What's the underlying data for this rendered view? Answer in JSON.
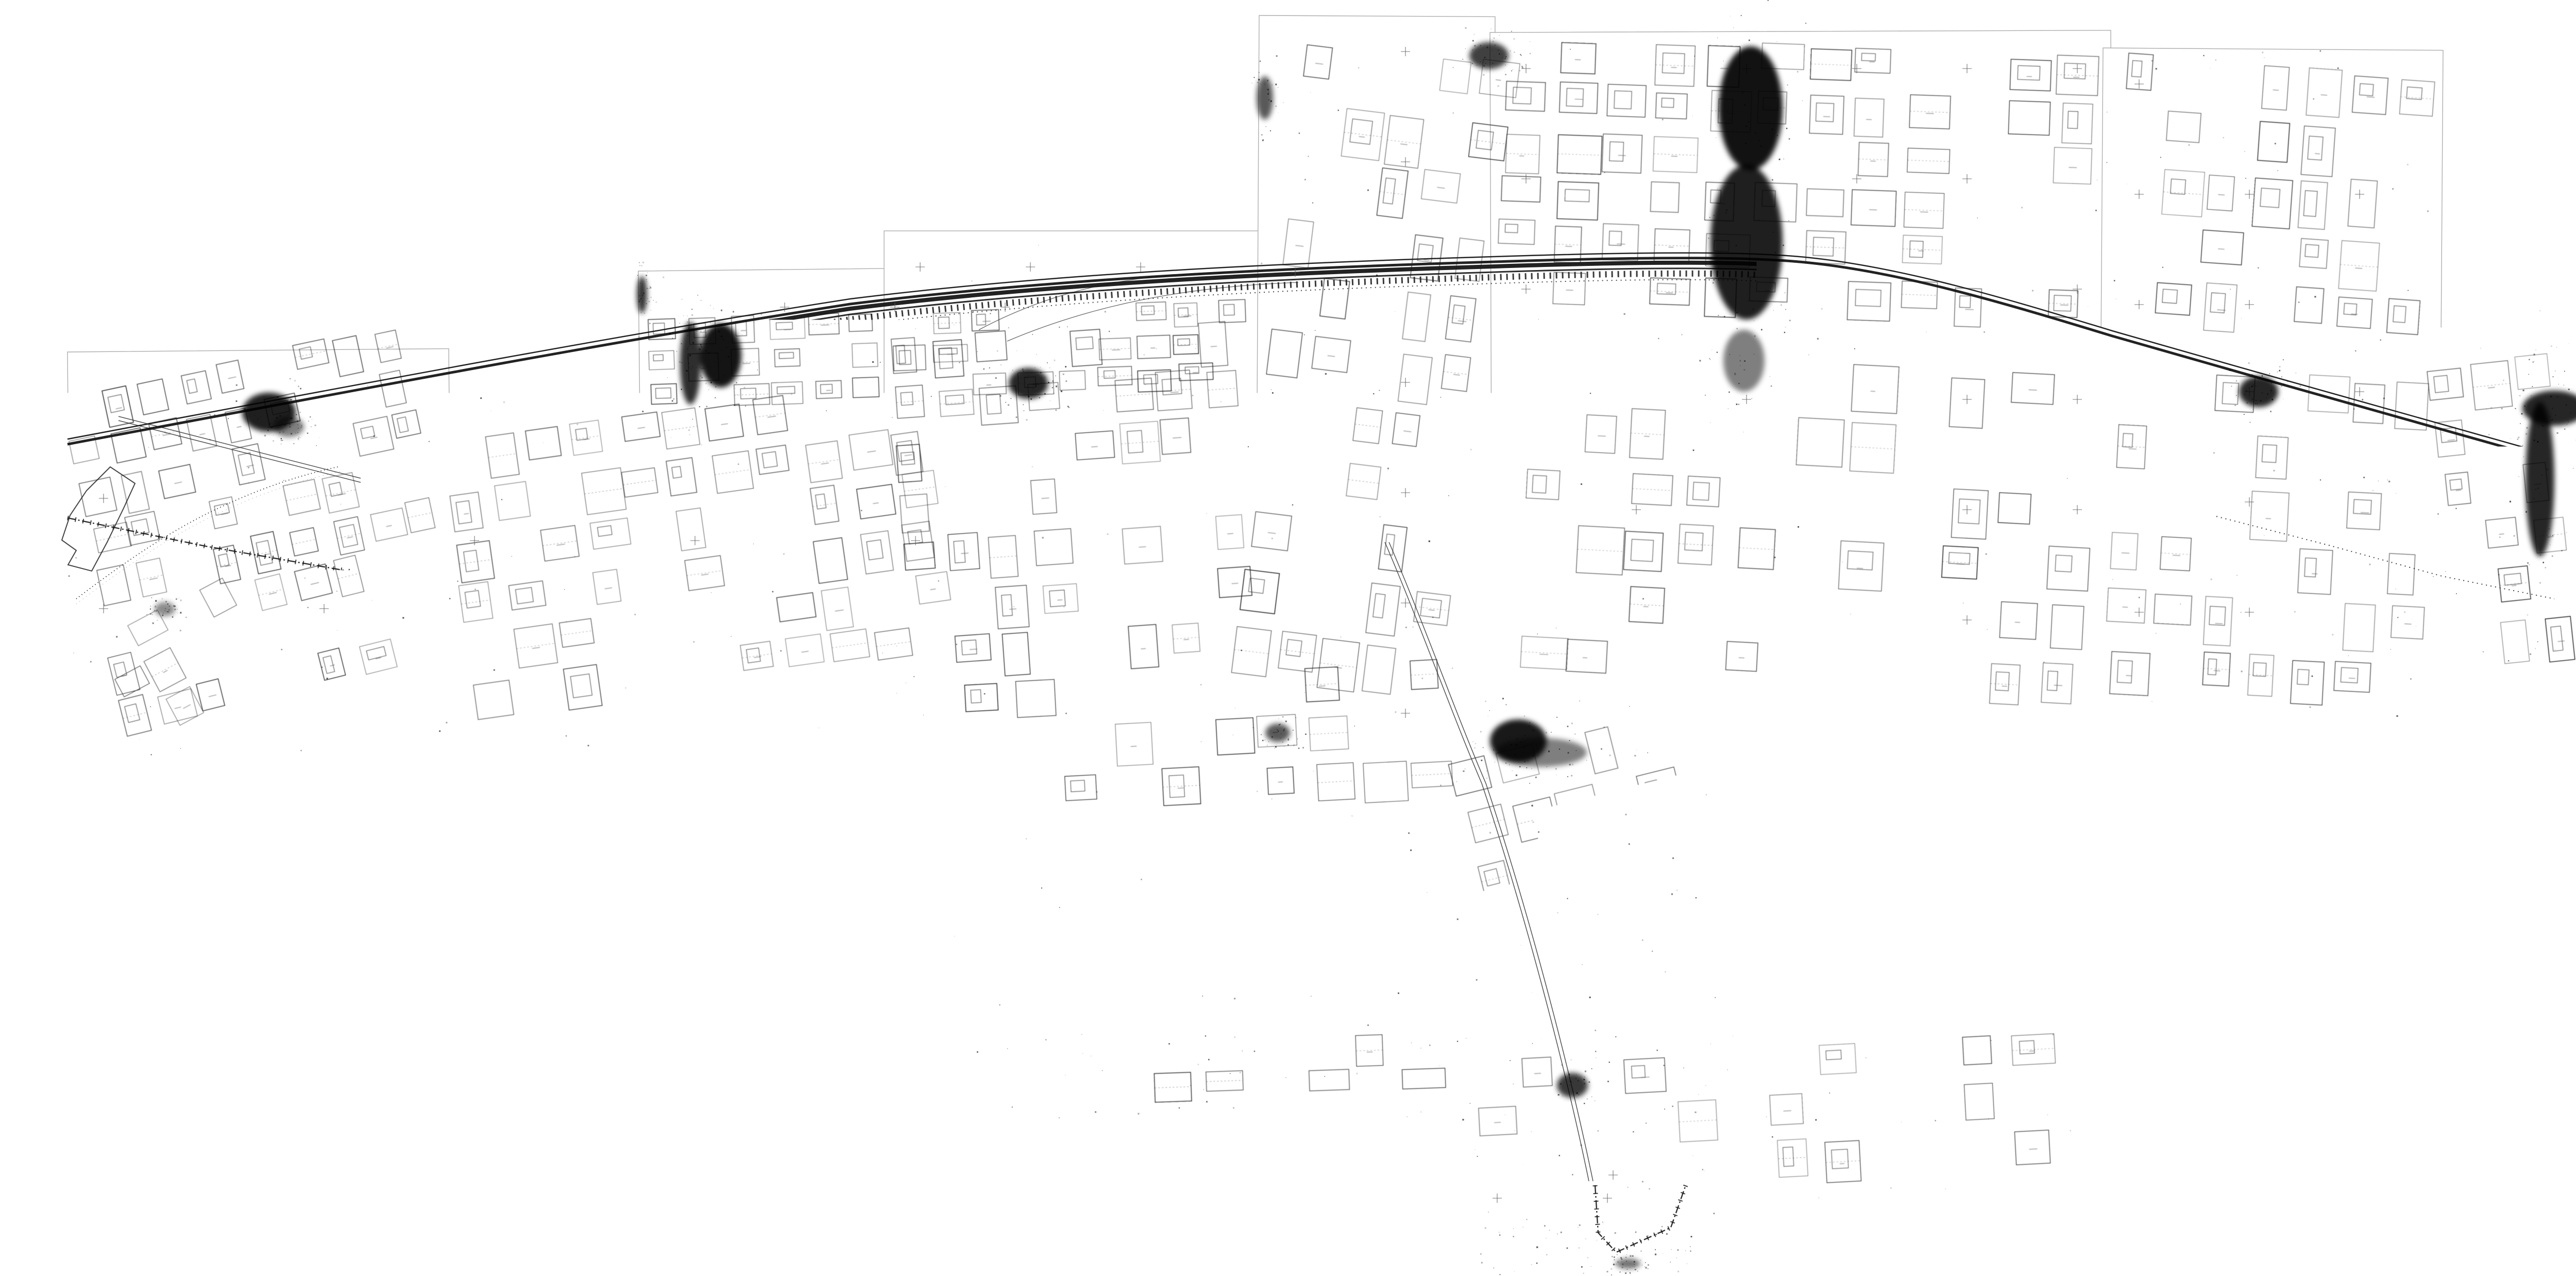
{
  "scale_label": "ΚΛΙΜΑΚΑ 1:500",
  "stamp": {
    "ministry_line1": "ΥΠΟΥΡΓΕΙΟ",
    "ministry_line2": "ΠΕΡΙΒΑΛΛΟΝΤΟΣ ΧΩΡΟΤΑΞΙΑΣ & ΔΗΜ. ΕΡΓΩΝ",
    "ref_no": "Γ.Β.8602/95",
    "date": "15 Μαΐου 1995",
    "signer_title": "Ο Διευθυντής",
    "office": "Γρ. Αποτυπώσεων"
  },
  "notes": {
    "file_no": "Αρ.Φ.Δ. 130/95",
    "sheet_no": "Αρ.Σχ. 27"
  },
  "colors": {
    "ink": "#161616",
    "faint": "#555555",
    "sheet_border": "#ADADAD",
    "paper": "#FFFFFF"
  },
  "map": {
    "sheets": [
      [
        1239,
        526,
        1230,
        272,
        -0.6
      ],
      [
        1716,
        448,
        738,
        1018,
        0
      ],
      [
        2444,
        30,
        458,
        1425,
        0.3
      ],
      [
        2892,
        63,
        1205,
        1350,
        -0.2
      ],
      [
        4082,
        93,
        660,
        610,
        0.4
      ],
      [
        4082,
        690,
        668,
        722,
        0
      ],
      [
        131,
        683,
        740,
        785,
        -0.5
      ],
      [
        851,
        765,
        1005,
        700,
        0.2
      ],
      [
        1847,
        1287,
        1002,
        816,
        0
      ],
      [
        2836,
        1399,
        546,
        1049,
        0
      ],
      [
        4731,
        664,
        516,
        650,
        -0.3
      ],
      [
        5238,
        1392,
        478,
        710,
        0.5
      ],
      [
        2847,
        1996,
        1183,
        373,
        0
      ],
      [
        1933,
        2000,
        920,
        170,
        0
      ],
      [
        2873,
        2369,
        429,
        105,
        0
      ]
    ],
    "paths": {
      "rail_main": "M131,862 C700,755 1200,660 1650,590 C2050,540 2500,520 2900,508 C3150,500 3330,498 3450,505 C3650,515 3880,585 4100,652 C4420,745 4800,848 5030,915 C5140,948 5210,965 5247,975",
      "rail_s12": "M5542,1398 C5585,1560 5640,1760 5672,1880 C5692,1958 5702,2010 5706,2060",
      "bndA": "M131,1005 L400,1060 L870,1142 L1180,1260 L1430,1322 L1854,1305 L2200,1345 L2560,1380 L2836,1402 L2912,1505 L2945,1710 L2908,1985 L2884,2290 L3095,2298 L3228,2278 L3425,2182 L3705,2256 L3992,2142 L4028,2098",
      "bndTail": "M3096,2300 L3102,2392 L3137,2430 L3243,2382 L3272,2300",
      "bndS12": "M5366,1560 L5420,1752 L5482,1952 L5520,2088",
      "coast": "M148,1162 C240,1092 330,1030 420,988 C520,940 600,918 660,905",
      "coast2": "M1854,1420 C2100,1520 2300,1640 2450,1760 C2560,1850 2650,1960 2700,2060",
      "pier": "M214,906 L168,952 L136,1000 L120,1048 L148,1068 L132,1096 L178,1108 L208,1052 L240,986 L262,938 Z",
      "street1": "M230,812 L700,932",
      "street2": "M2692,1052 C2760,1210 2820,1380 2880,1520 C2960,1760 3040,2060 3088,2292",
      "curve1": "M1900,640 C2050,560 2200,532 2380,528",
      "curve2": "M1955,662 C2120,592 2300,556 2520,548",
      "traverse": "M4302,1002 L4520,1058 L4740,1118 L4958,1162"
    },
    "clusters": [
      [
        150,
        690,
        690,
        430,
        -12,
        9,
        5,
        0.3,
        0.5
      ],
      [
        200,
        1120,
        560,
        260,
        -14,
        7,
        3,
        0.5,
        0.3
      ],
      [
        880,
        790,
        960,
        560,
        -8,
        11,
        6,
        0.35,
        0.45
      ],
      [
        1255,
        598,
        1180,
        185,
        -2,
        15,
        3,
        0.3,
        0.5
      ],
      [
        1740,
        630,
        690,
        680,
        -4,
        8,
        7,
        0.45,
        0.4
      ],
      [
        2460,
        90,
        420,
        1260,
        7,
        5,
        11,
        0.4,
        0.5
      ],
      [
        2910,
        85,
        1170,
        540,
        2,
        12,
        6,
        0.4,
        0.5
      ],
      [
        2950,
        700,
        1130,
        660,
        3,
        11,
        6,
        0.45,
        0.4
      ],
      [
        4100,
        120,
        630,
        540,
        4,
        7,
        5,
        0.55,
        0.35
      ],
      [
        4095,
        720,
        630,
        650,
        3,
        7,
        6,
        0.45,
        0.5
      ],
      [
        4740,
        680,
        495,
        610,
        -6,
        6,
        6,
        0.45,
        0.4
      ],
      [
        1865,
        1300,
        960,
        280,
        -3,
        10,
        3,
        0.55,
        0.3
      ],
      [
        2850,
        1408,
        520,
        400,
        -14,
        6,
        4,
        0.4,
        0.5
      ],
      [
        2862,
        2028,
        1140,
        270,
        -3,
        12,
        3,
        0.45,
        0.35
      ],
      [
        5252,
        1420,
        450,
        650,
        -17,
        5,
        7,
        0.4,
        0.45
      ],
      [
        205,
        1148,
        380,
        230,
        -28,
        5,
        3,
        0.5,
        0.3
      ],
      [
        1950,
        2006,
        860,
        140,
        -2,
        9,
        2,
        0.7,
        0.2
      ]
    ],
    "blobs": [
      [
        522,
        800,
        52,
        38,
        0.88
      ],
      [
        1399,
        690,
        40,
        62,
        0.92
      ],
      [
        1246,
        572,
        10,
        36,
        0.8
      ],
      [
        1996,
        744,
        38,
        30,
        0.85
      ],
      [
        2455,
        190,
        16,
        42,
        0.65
      ],
      [
        2890,
        108,
        38,
        26,
        0.75
      ],
      [
        3398,
        210,
        62,
        120,
        0.93
      ],
      [
        3390,
        470,
        70,
        150,
        0.88
      ],
      [
        3385,
        700,
        40,
        60,
        0.5
      ],
      [
        4384,
        760,
        38,
        30,
        0.85
      ],
      [
        4930,
        930,
        28,
        150,
        0.85
      ],
      [
        4958,
        792,
        62,
        34,
        0.85
      ],
      [
        5362,
        1468,
        55,
        45,
        0.88
      ],
      [
        2947,
        1438,
        55,
        42,
        0.9
      ],
      [
        2990,
        1460,
        90,
        28,
        0.5
      ],
      [
        3052,
        2106,
        30,
        24,
        0.78
      ],
      [
        2480,
        1422,
        24,
        18,
        0.65
      ],
      [
        5484,
        2052,
        85,
        26,
        0.7
      ],
      [
        5652,
        1995,
        35,
        55,
        0.75
      ],
      [
        320,
        1182,
        20,
        14,
        0.45
      ],
      [
        3160,
        2452,
        24,
        10,
        0.55
      ],
      [
        1340,
        705,
        20,
        80,
        0.82
      ],
      [
        560,
        828,
        30,
        20,
        0.5
      ]
    ],
    "scale_boxes": [
      [
        4363,
        104,
        330,
        "box"
      ],
      [
        1455,
        760,
        320,
        "box"
      ],
      [
        497,
        1424,
        170,
        "ticks"
      ]
    ],
    "stamps": [
      [
        610,
        1352,
        -2,
        "full",
        1
      ],
      [
        1262,
        1462,
        -1,
        "full",
        0.95
      ],
      [
        1495,
        1318,
        2,
        "full",
        0.9
      ],
      [
        2437,
        1196,
        -3,
        "full",
        1
      ],
      [
        2547,
        385,
        -10,
        "full",
        1.05
      ],
      [
        5000,
        800,
        -1,
        "full",
        1
      ],
      [
        3200,
        1842,
        -1,
        "hand",
        1
      ],
      [
        5358,
        1945,
        -2,
        "full",
        0.9
      ],
      [
        4105,
        495,
        -2,
        "hand",
        0.85
      ]
    ],
    "labels": [
      [
        "ΛΕΩΦΟΡΟΣ",
        400,
        830,
        16,
        11,
        "s"
      ],
      [
        "ΠΡΑΣΙΝΟ",
        452,
        806,
        13,
        0,
        "g"
      ],
      [
        "Κ",
        440,
        880,
        20,
        0,
        "B"
      ],
      [
        "ΕΜ",
        396,
        904,
        16,
        0,
        "g"
      ],
      [
        "ΟΤ. 2238",
        378,
        928,
        19,
        0,
        "b"
      ],
      [
        "Γ",
        398,
        948,
        20,
        0,
        "B"
      ],
      [
        "ΟΤ 2238",
        330,
        958,
        19,
        0,
        "b"
      ],
      [
        "ΕΜ",
        342,
        978,
        16,
        0,
        "g"
      ],
      [
        "ΠΡΑΣΙΝΟ",
        455,
        906,
        12,
        0,
        "g"
      ],
      [
        "ΟΤ.2233α",
        446,
        924,
        17,
        0,
        "b"
      ],
      [
        "ΟΤ. 2236",
        452,
        1044,
        19,
        0,
        "b"
      ],
      [
        "Α",
        462,
        1064,
        20,
        0,
        "B"
      ],
      [
        "Α",
        168,
        910,
        20,
        0,
        "B"
      ],
      [
        "Δ",
        128,
        1000,
        20,
        0,
        "B"
      ],
      [
        "ΟΤ 2159α",
        178,
        1028,
        15,
        0,
        "b"
      ],
      [
        "Α",
        200,
        1048,
        18,
        0,
        "B"
      ],
      [
        "ΟΤ 2243α",
        1300,
        610,
        15,
        0,
        "b"
      ],
      [
        "ΟΤ.2243β",
        1372,
        616,
        14,
        0,
        "b"
      ],
      [
        "ΠΡΑΣΙΝΟ",
        1372,
        630,
        11,
        0,
        "g"
      ],
      [
        "ΟΤ 2243",
        1322,
        660,
        17,
        0,
        "b"
      ],
      [
        "Γ",
        1390,
        676,
        18,
        0,
        "B"
      ],
      [
        "ΟΤ.2244β",
        1478,
        656,
        15,
        0,
        "b"
      ],
      [
        "Γ",
        1498,
        678,
        18,
        0,
        "B"
      ],
      [
        "Κ",
        1572,
        612,
        14,
        0,
        "B"
      ],
      [
        "ΠΡΑΣΙΝΟ",
        1596,
        611,
        12,
        0,
        "g"
      ],
      [
        "ΟΤ.2245α",
        1572,
        626,
        15,
        0,
        "b"
      ],
      [
        "ΟΤ 2245",
        1592,
        668,
        17,
        0,
        "b"
      ],
      [
        "Γ",
        1608,
        688,
        18,
        0,
        "B"
      ],
      [
        "ΟΤ 2246",
        1692,
        628,
        15,
        0,
        "b"
      ],
      [
        "Γ",
        1698,
        650,
        16,
        0,
        "B"
      ],
      [
        "ΟΤ 2210",
        1272,
        722,
        16,
        0,
        "b"
      ],
      [
        "ΟΤ 2209",
        1375,
        738,
        15,
        0,
        "b"
      ],
      [
        "Γ",
        1448,
        746,
        15,
        0,
        "B"
      ],
      [
        "ΟΤ 2204",
        1470,
        746,
        16,
        0,
        "b"
      ],
      [
        "ΟΤ 2201",
        1592,
        748,
        15,
        0,
        "b"
      ],
      [
        "ΟΤ 2209",
        1330,
        836,
        14,
        0,
        "b"
      ],
      [
        "ΟΤ 2204",
        1418,
        826,
        14,
        0,
        "b"
      ],
      [
        "ΟΤ 2196",
        1650,
        820,
        14,
        0,
        "b"
      ],
      [
        "ΠΕΖΟΔΡΟΜΟΣ",
        1298,
        628,
        9,
        22,
        "p"
      ],
      [
        "ΠΕΖΟΔΡΟΜΟΣ",
        1470,
        594,
        9,
        14,
        "p"
      ],
      [
        "ΛΕΩΦΟΡΟΣ ΠΡΩΤΕΩΣ",
        1430,
        585,
        11,
        -9,
        "h2"
      ],
      [
        "Α",
        2723,
        1086,
        18,
        0,
        "B"
      ],
      [
        "ΟΤ 2113 β",
        2665,
        1118,
        16,
        0,
        "b"
      ],
      [
        "Δ",
        2760,
        1162,
        18,
        0,
        "B"
      ],
      [
        "ΟΤ 2119",
        2738,
        1180,
        17,
        0,
        "b"
      ],
      [
        "ΠΚ",
        4306,
        908,
        15,
        0,
        "g"
      ],
      [
        "ΟΤ.2271",
        4398,
        922,
        15,
        0,
        "b"
      ],
      [
        "ΠΚ",
        4400,
        940,
        14,
        0,
        "g"
      ],
      [
        "ΟΤ 2273",
        4488,
        984,
        15,
        0,
        "b"
      ],
      [
        "ΠΚ",
        4495,
        1004,
        14,
        0,
        "g"
      ],
      [
        "ΠΚ",
        4592,
        1028,
        14,
        0,
        "g"
      ],
      [
        "ΟΤ 2275",
        4588,
        1044,
        15,
        0,
        "b"
      ],
      [
        "ΠΚ",
        4624,
        1042,
        13,
        0,
        "g"
      ],
      [
        "ΟΤ 2275",
        4622,
        1058,
        13,
        0,
        "b"
      ],
      [
        "ΠΚ",
        4706,
        1030,
        15,
        0,
        "g"
      ],
      [
        "ΟΤ 2277",
        4705,
        1046,
        15,
        0,
        "b"
      ],
      [
        "ΟΤ 2274",
        4690,
        893,
        13,
        0,
        "b"
      ],
      [
        "ΟΤ 2276",
        4712,
        962,
        13,
        0,
        "b"
      ],
      [
        "Γ 265",
        4372,
        1042,
        13,
        0,
        "f"
      ],
      [
        "Γ 280",
        4438,
        1104,
        12,
        0,
        "f"
      ],
      [
        "Γ 236",
        4492,
        1104,
        12,
        0,
        "f"
      ],
      [
        "Γ 272",
        4630,
        1144,
        12,
        0,
        "f"
      ],
      [
        "Γ 267",
        4712,
        1160,
        12,
        0,
        "f"
      ],
      [
        "Γ 266",
        4772,
        1170,
        12,
        0,
        "f"
      ],
      [
        "Ζωφρια",
        4418,
        1108,
        34,
        -2,
        "h"
      ],
      [
        "Σ",
        4448,
        1142,
        28,
        0,
        "h"
      ],
      [
        "ΟΤ.2144",
        2928,
        2130,
        17,
        0,
        "b"
      ],
      [
        "Α",
        2945,
        2152,
        18,
        0,
        "B"
      ],
      [
        "ΟΤ.2145",
        2908,
        2230,
        17,
        0,
        "b"
      ],
      [
        "Α",
        2928,
        2254,
        18,
        0,
        "B"
      ],
      [
        "ΟΤ.2138",
        3018,
        2186,
        16,
        0,
        "b"
      ],
      [
        "Α",
        3038,
        2208,
        17,
        0,
        "B"
      ],
      [
        "ΟΤ. 2129",
        3095,
        2202,
        17,
        0,
        "b"
      ],
      [
        "Α",
        3118,
        2224,
        18,
        0,
        "B"
      ],
      [
        "ΟΤ. 2128",
        3122,
        2122,
        15,
        0,
        "b"
      ],
      [
        "Α",
        3146,
        2140,
        16,
        0,
        "B"
      ],
      [
        "ΟΤ.2127",
        3178,
        2172,
        16,
        0,
        "b"
      ],
      [
        "Α",
        3198,
        2194,
        17,
        0,
        "B"
      ],
      [
        "ΠΕΖΟΔΡΟΜΟΣ",
        3082,
        2148,
        9,
        -3,
        "p"
      ],
      [
        "ΠΕΖΟΔΡΟΜΟΣ",
        2918,
        2172,
        9,
        28,
        "p"
      ],
      [
        "Γ",
        2934,
        2066,
        14,
        0,
        "B"
      ],
      [
        "ΟΤ.2284α",
        5372,
        1598,
        13,
        0,
        "b"
      ],
      [
        "Κ",
        5392,
        1614,
        14,
        0,
        "B"
      ],
      [
        "ΠΡΑΣΙΝΟ",
        5380,
        1626,
        11,
        0,
        "g"
      ],
      [
        "ΟΤ. 2284",
        5448,
        1590,
        15,
        0,
        "b"
      ],
      [
        "ΟΤ 2284 β",
        5368,
        1654,
        12,
        0,
        "b"
      ],
      [
        "Γ",
        5508,
        1706,
        15,
        0,
        "B"
      ],
      [
        "ΟΤ 2285",
        5498,
        1722,
        15,
        0,
        "b"
      ],
      [
        "ΟΤ2285α",
        5420,
        1736,
        13,
        0,
        "b"
      ],
      [
        "Κ",
        5436,
        1752,
        13,
        0,
        "B"
      ],
      [
        "ΠΡΑΣΙΝΟ",
        5426,
        1762,
        11,
        0,
        "g"
      ],
      [
        "ΟΤ 2286",
        5568,
        1878,
        15,
        0,
        "b"
      ],
      [
        "Γ",
        5582,
        1900,
        15,
        0,
        "B"
      ],
      [
        "ΟΤ.2286α",
        5488,
        1908,
        13,
        0,
        "b"
      ],
      [
        "Κ",
        5505,
        1924,
        13,
        0,
        "B"
      ],
      [
        "ΟΤ 2288 β",
        5592,
        1634,
        13,
        0,
        "b"
      ],
      [
        "Γ",
        5612,
        1654,
        14,
        0,
        "B"
      ],
      [
        "ΟΤ 2288",
        5652,
        1766,
        13,
        0,
        "b"
      ],
      [
        "ΟΤ 2291",
        5652,
        1568,
        13,
        0,
        "b"
      ],
      [
        "ΠΕΖΟΔΡΟΜΟΣ",
        5378,
        1762,
        9,
        76,
        "p"
      ],
      [
        "ΑΝΤΙΣΤΑΣΕΩΣ",
        3440,
        182,
        16,
        3,
        "s2"
      ],
      [
        "×",
        4302,
        1002,
        16,
        0,
        "x"
      ],
      [
        "×",
        4412,
        1030,
        16,
        0,
        "x"
      ],
      [
        "×",
        4520,
        1058,
        16,
        0,
        "x"
      ],
      [
        "×",
        4648,
        1092,
        16,
        0,
        "x"
      ],
      [
        "×",
        4740,
        1118,
        16,
        0,
        "x"
      ],
      [
        "×",
        4862,
        1144,
        16,
        0,
        "x"
      ]
    ]
  }
}
